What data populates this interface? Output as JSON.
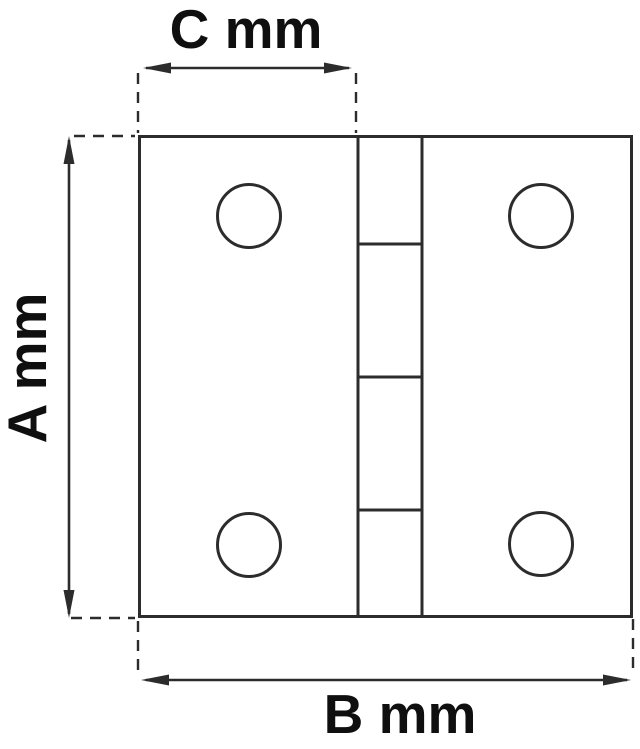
{
  "diagram": {
    "type": "technical-drawing",
    "subject": "Butt hinge front view with dimension callouts",
    "labels": {
      "width_top": "C mm",
      "height_left": "A mm",
      "width_bottom": "B mm"
    },
    "colors": {
      "background": "#ffffff",
      "line": "#2c2c2c",
      "text": "#0f0f0f"
    }
  }
}
